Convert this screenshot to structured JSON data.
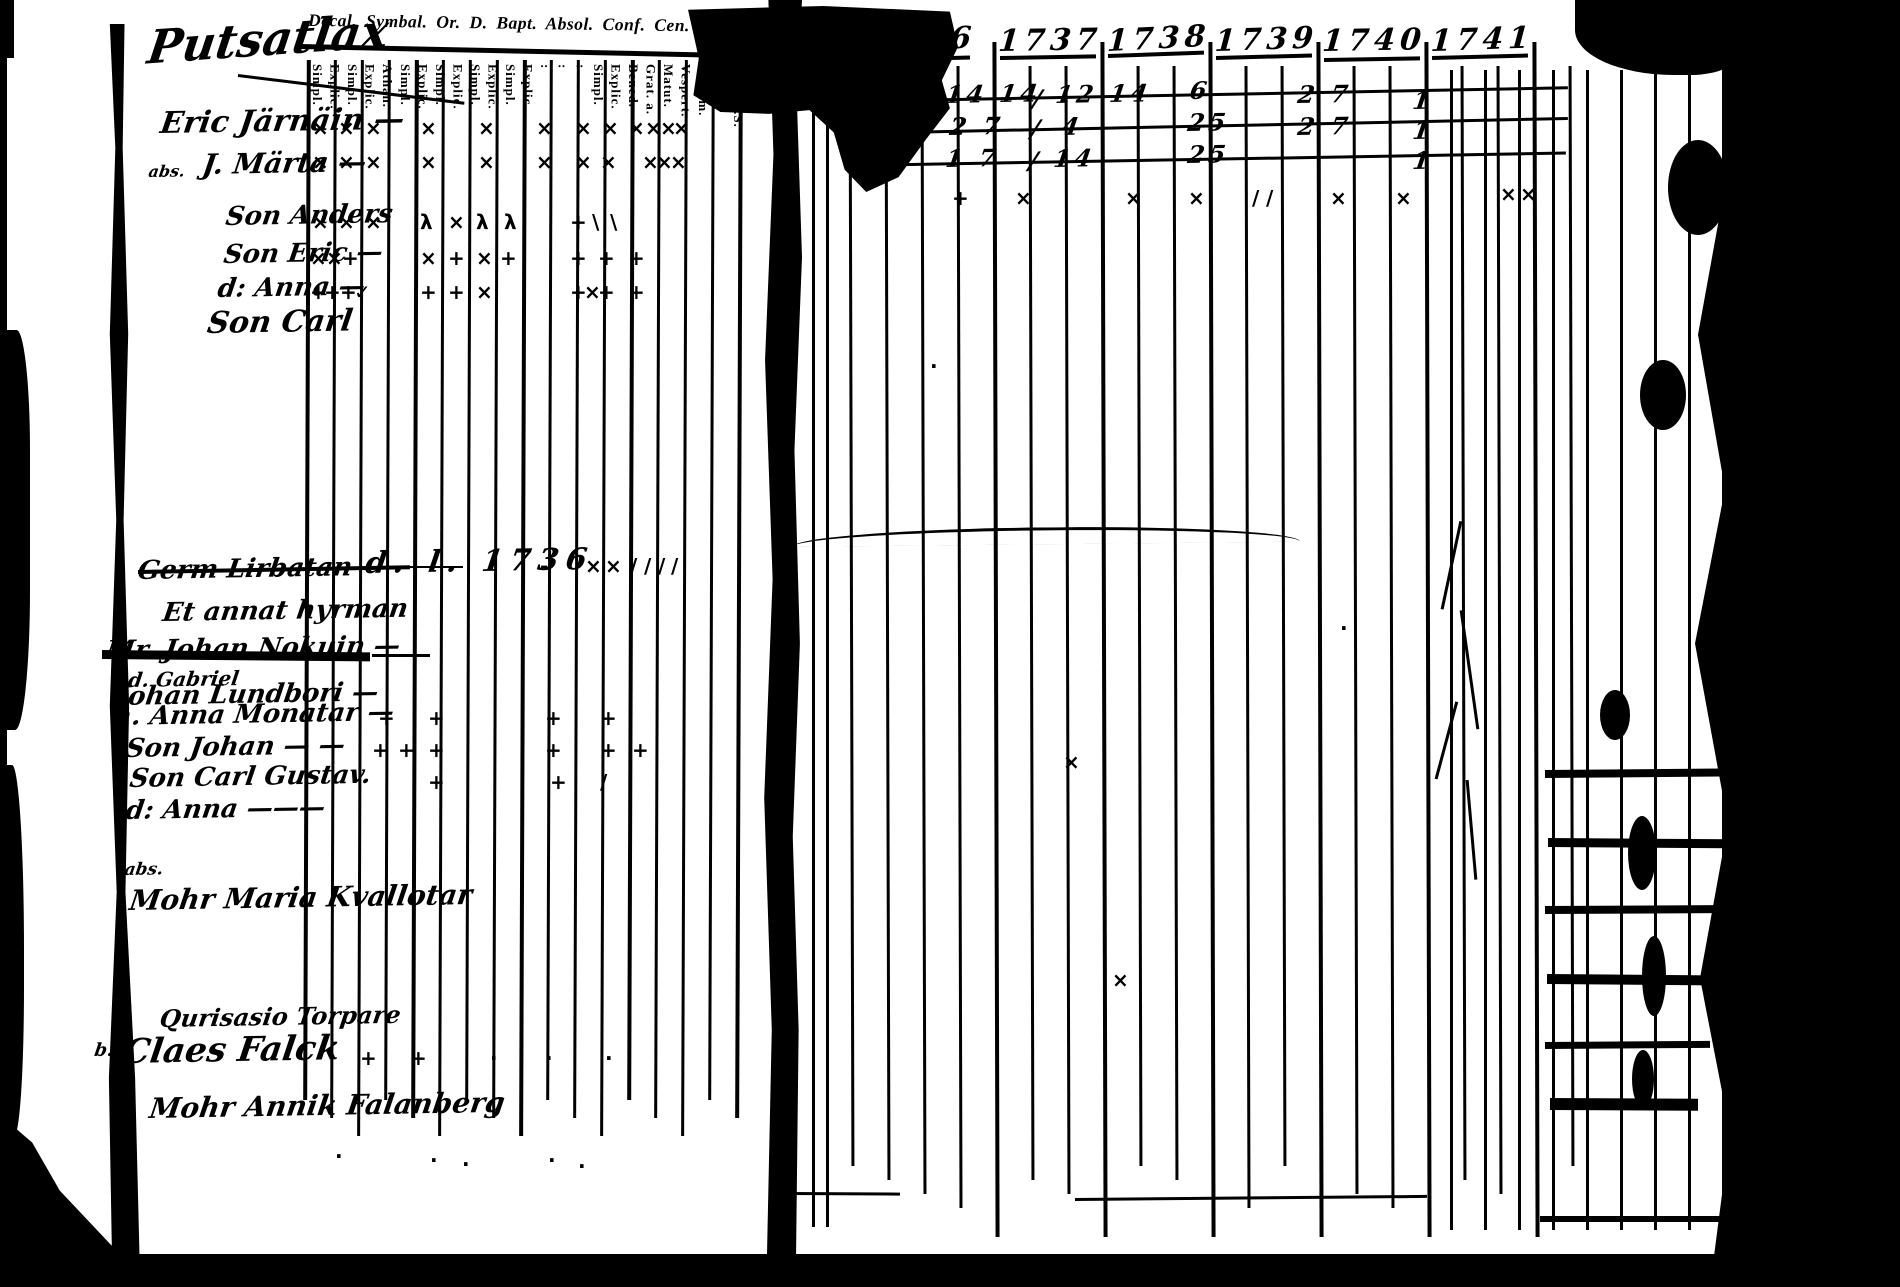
{
  "doc": {
    "colors": {
      "ink": "#000000",
      "paper": "#ffffff"
    },
    "handwritten_title": "Putsatlax",
    "printed_header": "Decal. Symbal. Or. D. Bapt. Absol. Conf. Cen. D. Mensal. Orat. Quæst.",
    "column_labels": [
      "Simpl.",
      "Explic.",
      "Simpl.",
      "Explic.",
      "Athan.",
      "Simpl.",
      "Explic.",
      "Simpl.",
      "Explic.",
      "Simpl.",
      "Explic.",
      "Simpl.",
      "Explic.",
      ":",
      ":",
      ":",
      "Simpl.",
      "Explic.",
      "Bened.",
      "Grat. a.",
      "Matut.",
      "Vespert.",
      "Aliq. m.",
      "Plenius",
      "Dicta S.S."
    ],
    "years": [
      "1736",
      "1737",
      "1738",
      "1739",
      "1740",
      "1741"
    ],
    "names": [
      {
        "t": "Eric Järnäin —",
        "x": 163,
        "y": 106,
        "s": 30
      },
      {
        "t": "abs.",
        "x": 150,
        "y": 162,
        "s": 16
      },
      {
        "t": "J. Märta —",
        "x": 205,
        "y": 148,
        "s": 28
      },
      {
        "t": "Son Anders",
        "x": 228,
        "y": 202,
        "s": 26
      },
      {
        "t": "Son Eric —",
        "x": 226,
        "y": 240,
        "s": 26
      },
      {
        "t": "d: Anna —",
        "x": 220,
        "y": 274,
        "s": 26
      },
      {
        "t": "Son Carl",
        "x": 210,
        "y": 306,
        "s": 30
      },
      {
        "t": "Germ Lirbatan",
        "x": 140,
        "y": 556,
        "s": 26
      },
      {
        "t": "Et annat hyrman",
        "x": 165,
        "y": 598,
        "s": 26
      },
      {
        "t": "Mr. Johan Nokuin —",
        "x": 108,
        "y": 636,
        "s": 26
      },
      {
        "t": "d. Gabriel",
        "x": 130,
        "y": 668,
        "s": 20
      },
      {
        "t": "Johan Lundbori —",
        "x": 118,
        "y": 682,
        "s": 26
      },
      {
        "t": "h. Anna Monatar —",
        "x": 115,
        "y": 702,
        "s": 26
      },
      {
        "t": "Son Johan — —",
        "x": 128,
        "y": 734,
        "s": 26
      },
      {
        "t": "Son Carl Gustav.",
        "x": 132,
        "y": 764,
        "s": 26
      },
      {
        "t": "d: Anna ———",
        "x": 128,
        "y": 796,
        "s": 26
      },
      {
        "t": "abs.",
        "x": 126,
        "y": 860,
        "s": 17
      },
      {
        "t": "Mohr Maria Kvallotar",
        "x": 132,
        "y": 884,
        "s": 28
      },
      {
        "t": "Qurisasio Torpare",
        "x": 162,
        "y": 1004,
        "s": 24
      },
      {
        "t": "b.",
        "x": 96,
        "y": 1040,
        "s": 18
      },
      {
        "t": "Claes Falck",
        "x": 126,
        "y": 1032,
        "s": 34
      },
      {
        "t": "Mohr Annik Falanberg",
        "x": 152,
        "y": 1092,
        "s": 28
      }
    ],
    "annotations": [
      {
        "t": "d. l. 1736",
        "x": 368,
        "y": 546,
        "s": 30
      }
    ],
    "numbers": [
      {
        "x": 948,
        "y": 80,
        "t": "14 14"
      },
      {
        "x": 952,
        "y": 112,
        "t": "2 7"
      },
      {
        "x": 948,
        "y": 144,
        "t": "1 7"
      },
      {
        "x": 1035,
        "y": 84,
        "t": "/"
      },
      {
        "x": 1033,
        "y": 114,
        "t": "/"
      },
      {
        "x": 1031,
        "y": 146,
        "t": "/"
      },
      {
        "x": 1058,
        "y": 80,
        "t": "12 14"
      },
      {
        "x": 1064,
        "y": 112,
        "t": "4"
      },
      {
        "x": 1056,
        "y": 144,
        "t": "14"
      },
      {
        "x": 1192,
        "y": 76,
        "t": "6"
      },
      {
        "x": 1190,
        "y": 108,
        "t": "25"
      },
      {
        "x": 1190,
        "y": 140,
        "t": "25"
      },
      {
        "x": 1300,
        "y": 80,
        "t": "2 7"
      },
      {
        "x": 1300,
        "y": 112,
        "t": "2 7"
      },
      {
        "x": 1415,
        "y": 86,
        "t": "1"
      },
      {
        "x": 1415,
        "y": 116,
        "t": "1"
      },
      {
        "x": 1415,
        "y": 146,
        "t": "1"
      }
    ],
    "marks": [
      {
        "x": 312,
        "y": 118,
        "g": "×"
      },
      {
        "x": 338,
        "y": 118,
        "g": "×"
      },
      {
        "x": 365,
        "y": 118,
        "g": "×"
      },
      {
        "x": 420,
        "y": 118,
        "g": "×"
      },
      {
        "x": 478,
        "y": 118,
        "g": "×"
      },
      {
        "x": 536,
        "y": 118,
        "g": "×"
      },
      {
        "x": 575,
        "y": 118,
        "g": "×"
      },
      {
        "x": 602,
        "y": 118,
        "g": "×"
      },
      {
        "x": 628,
        "y": 118,
        "g": "×"
      },
      {
        "x": 645,
        "y": 118,
        "g": "×"
      },
      {
        "x": 660,
        "y": 118,
        "g": "×"
      },
      {
        "x": 673,
        "y": 118,
        "g": "×"
      },
      {
        "x": 312,
        "y": 152,
        "g": "×"
      },
      {
        "x": 338,
        "y": 152,
        "g": "×"
      },
      {
        "x": 365,
        "y": 152,
        "g": "×"
      },
      {
        "x": 420,
        "y": 152,
        "g": "×"
      },
      {
        "x": 478,
        "y": 152,
        "g": "×"
      },
      {
        "x": 536,
        "y": 152,
        "g": "×"
      },
      {
        "x": 575,
        "y": 152,
        "g": "×"
      },
      {
        "x": 600,
        "y": 152,
        "g": "×"
      },
      {
        "x": 642,
        "y": 152,
        "g": "×"
      },
      {
        "x": 656,
        "y": 152,
        "g": "×"
      },
      {
        "x": 670,
        "y": 152,
        "g": "×"
      },
      {
        "x": 312,
        "y": 212,
        "g": "×"
      },
      {
        "x": 338,
        "y": 212,
        "g": "×"
      },
      {
        "x": 365,
        "y": 212,
        "g": "×"
      },
      {
        "x": 420,
        "y": 212,
        "g": "λ"
      },
      {
        "x": 448,
        "y": 212,
        "g": "×"
      },
      {
        "x": 476,
        "y": 212,
        "g": "λ"
      },
      {
        "x": 504,
        "y": 212,
        "g": "λ"
      },
      {
        "x": 570,
        "y": 212,
        "g": "+"
      },
      {
        "x": 592,
        "y": 212,
        "g": "\\"
      },
      {
        "x": 610,
        "y": 212,
        "g": "\\"
      },
      {
        "x": 310,
        "y": 248,
        "g": "×"
      },
      {
        "x": 326,
        "y": 248,
        "g": "×"
      },
      {
        "x": 342,
        "y": 248,
        "g": "+"
      },
      {
        "x": 420,
        "y": 248,
        "g": "×"
      },
      {
        "x": 448,
        "y": 248,
        "g": "+"
      },
      {
        "x": 476,
        "y": 248,
        "g": "×"
      },
      {
        "x": 500,
        "y": 248,
        "g": "+"
      },
      {
        "x": 570,
        "y": 248,
        "g": "+"
      },
      {
        "x": 598,
        "y": 248,
        "g": "+"
      },
      {
        "x": 628,
        "y": 248,
        "g": "+"
      },
      {
        "x": 310,
        "y": 282,
        "g": "+"
      },
      {
        "x": 324,
        "y": 282,
        "g": "+"
      },
      {
        "x": 340,
        "y": 282,
        "g": "+"
      },
      {
        "x": 354,
        "y": 282,
        "g": "✓"
      },
      {
        "x": 420,
        "y": 282,
        "g": "+"
      },
      {
        "x": 448,
        "y": 282,
        "g": "+"
      },
      {
        "x": 476,
        "y": 282,
        "g": "×"
      },
      {
        "x": 570,
        "y": 282,
        "g": "+"
      },
      {
        "x": 584,
        "y": 282,
        "g": "×"
      },
      {
        "x": 598,
        "y": 282,
        "g": "+"
      },
      {
        "x": 628,
        "y": 282,
        "g": "+"
      },
      {
        "x": 540,
        "y": 556,
        "g": "-"
      },
      {
        "x": 585,
        "y": 556,
        "g": "×"
      },
      {
        "x": 605,
        "y": 556,
        "g": "×"
      },
      {
        "x": 630,
        "y": 556,
        "g": "/"
      },
      {
        "x": 644,
        "y": 556,
        "g": "/"
      },
      {
        "x": 658,
        "y": 556,
        "g": "/"
      },
      {
        "x": 671,
        "y": 556,
        "g": "/"
      },
      {
        "x": 378,
        "y": 708,
        "g": "+"
      },
      {
        "x": 428,
        "y": 708,
        "g": "+"
      },
      {
        "x": 545,
        "y": 708,
        "g": "+"
      },
      {
        "x": 600,
        "y": 708,
        "g": "+"
      },
      {
        "x": 372,
        "y": 740,
        "g": "+"
      },
      {
        "x": 398,
        "y": 740,
        "g": "+"
      },
      {
        "x": 428,
        "y": 740,
        "g": "+"
      },
      {
        "x": 545,
        "y": 740,
        "g": "+"
      },
      {
        "x": 600,
        "y": 740,
        "g": "+"
      },
      {
        "x": 632,
        "y": 740,
        "g": "+"
      },
      {
        "x": 428,
        "y": 772,
        "g": "+"
      },
      {
        "x": 550,
        "y": 772,
        "g": "+"
      },
      {
        "x": 600,
        "y": 772,
        "g": "/"
      },
      {
        "x": 360,
        "y": 1048,
        "g": "+"
      },
      {
        "x": 410,
        "y": 1048,
        "g": "+"
      },
      {
        "x": 490,
        "y": 1048,
        "g": "·"
      },
      {
        "x": 545,
        "y": 1048,
        "g": "·"
      },
      {
        "x": 605,
        "y": 1048,
        "g": "·"
      },
      {
        "x": 335,
        "y": 1146,
        "g": "·"
      },
      {
        "x": 430,
        "y": 1150,
        "g": "·"
      },
      {
        "x": 462,
        "y": 1154,
        "g": "·"
      },
      {
        "x": 548,
        "y": 1150,
        "g": "·"
      },
      {
        "x": 578,
        "y": 1156,
        "g": "·"
      },
      {
        "x": 952,
        "y": 188,
        "g": "+"
      },
      {
        "x": 1015,
        "y": 188,
        "g": "×"
      },
      {
        "x": 1125,
        "y": 188,
        "g": "×"
      },
      {
        "x": 1188,
        "y": 188,
        "g": "×"
      },
      {
        "x": 1252,
        "y": 188,
        "g": "/"
      },
      {
        "x": 1266,
        "y": 188,
        "g": "/"
      },
      {
        "x": 1330,
        "y": 188,
        "g": "×"
      },
      {
        "x": 1395,
        "y": 188,
        "g": "×"
      },
      {
        "x": 1500,
        "y": 184,
        "g": "×"
      },
      {
        "x": 1520,
        "y": 184,
        "g": "×"
      },
      {
        "x": 1063,
        "y": 752,
        "g": "×"
      },
      {
        "x": 1112,
        "y": 970,
        "g": "×"
      },
      {
        "x": 930,
        "y": 356,
        "g": "·"
      },
      {
        "x": 1340,
        "y": 618,
        "g": "·"
      }
    ],
    "ink_lines": [
      {
        "x": 300,
        "y": 44,
        "w": 462,
        "h": 5,
        "r": 1.2
      },
      {
        "x": 798,
        "y": 70,
        "w": 132,
        "h": 4,
        "r": -2
      },
      {
        "x": 874,
        "y": 58,
        "w": 96,
        "h": 4,
        "r": -1.5
      },
      {
        "x": 1000,
        "y": 56,
        "w": 96,
        "h": 4,
        "r": -1
      },
      {
        "x": 1108,
        "y": 54,
        "w": 96,
        "h": 4,
        "r": -2
      },
      {
        "x": 1216,
        "y": 56,
        "w": 96,
        "h": 4,
        "r": -1.5
      },
      {
        "x": 1324,
        "y": 58,
        "w": 96,
        "h": 4,
        "r": -1
      },
      {
        "x": 1432,
        "y": 56,
        "w": 96,
        "h": 4,
        "r": -1.5
      },
      {
        "x": 852,
        "y": 100,
        "w": 716,
        "h": 3,
        "r": -1.1
      },
      {
        "x": 852,
        "y": 132,
        "w": 716,
        "h": 3,
        "r": -1.2
      },
      {
        "x": 852,
        "y": 164,
        "w": 714,
        "h": 3,
        "r": -1.0
      },
      {
        "x": 792,
        "y": 530,
        "w": 508,
        "h": 14,
        "r": -0.6,
        "c": 1
      },
      {
        "x": 138,
        "y": 570,
        "w": 272,
        "h": 4,
        "r": -1
      },
      {
        "x": 408,
        "y": 566,
        "w": 55,
        "h": 2,
        "r": 0
      },
      {
        "x": 102,
        "y": 650,
        "w": 268,
        "h": 9,
        "r": 0.5
      },
      {
        "x": 372,
        "y": 654,
        "w": 58,
        "h": 3,
        "r": 0
      },
      {
        "x": 238,
        "y": 74,
        "w": 228,
        "h": 3,
        "r": 7
      },
      {
        "x": 1075,
        "y": 1198,
        "w": 352,
        "h": 3,
        "r": -0.5
      },
      {
        "x": 788,
        "y": 1192,
        "w": 112,
        "h": 3,
        "r": 0.3
      },
      {
        "x": 1540,
        "y": 1216,
        "w": 185,
        "h": 6,
        "r": 0
      },
      {
        "x": 1545,
        "y": 770,
        "w": 175,
        "h": 8,
        "r": -0.5
      },
      {
        "x": 1548,
        "y": 838,
        "w": 180,
        "h": 9,
        "r": 0.4
      },
      {
        "x": 1545,
        "y": 906,
        "w": 170,
        "h": 8,
        "r": -0.3
      },
      {
        "x": 1547,
        "y": 974,
        "w": 178,
        "h": 10,
        "r": 0.5
      },
      {
        "x": 1545,
        "y": 1042,
        "w": 165,
        "h": 7,
        "r": -0.4
      },
      {
        "x": 1550,
        "y": 1098,
        "w": 148,
        "h": 12,
        "r": 0.3
      },
      {
        "x": 1450,
        "y": 520,
        "w": 3,
        "h": 90,
        "r": 12
      },
      {
        "x": 1468,
        "y": 610,
        "w": 3,
        "h": 120,
        "r": -8
      },
      {
        "x": 1445,
        "y": 700,
        "w": 3,
        "h": 80,
        "r": 15
      },
      {
        "x": 1470,
        "y": 780,
        "w": 3,
        "h": 100,
        "r": -5
      }
    ],
    "ink_blobs": [
      {
        "x": 1628,
        "y": 816,
        "w": 28,
        "h": 74
      },
      {
        "x": 1642,
        "y": 936,
        "w": 24,
        "h": 80
      },
      {
        "x": 1632,
        "y": 1050,
        "w": 22,
        "h": 58
      },
      {
        "x": 1668,
        "y": 140,
        "w": 60,
        "h": 95
      },
      {
        "x": 1640,
        "y": 360,
        "w": 46,
        "h": 70
      },
      {
        "x": 1600,
        "y": 690,
        "w": 30,
        "h": 50
      }
    ]
  }
}
